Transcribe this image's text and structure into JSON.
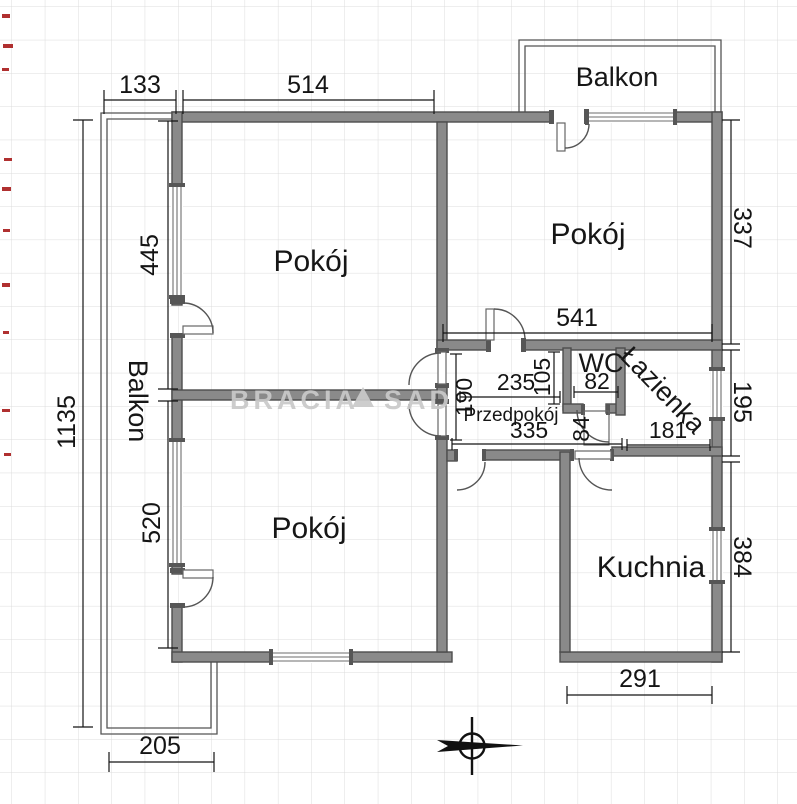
{
  "plan": {
    "watermark": {
      "part1": "BRACIA",
      "part2": "SAD"
    },
    "rooms": {
      "room_top_left": "Pokój",
      "room_top_right": "Pokój",
      "room_bottom_left": "Pokój",
      "kitchen": "Kuchnia",
      "bathroom": "Łazienka",
      "wc": "WC",
      "hallway": "Przedpokój",
      "balcony_left": "Balkon",
      "balcony_top": "Balkon"
    },
    "dims": {
      "d133": "133",
      "d514": "514",
      "d445": "445",
      "d520": "520",
      "d1135": "1135",
      "d205": "205",
      "d541": "541",
      "d337": "337",
      "d195": "195",
      "d384": "384",
      "d291": "291",
      "d235": "235",
      "d190": "190",
      "d105": "105",
      "d335": "335",
      "d82": "82",
      "d84": "84",
      "d181": "181"
    },
    "colors": {
      "wall": "#8a8a8a",
      "wall_outline": "#4d4d4d",
      "dimension_text": "#141414",
      "grid": "#dcdcdc",
      "watermark": "#c9c9c9",
      "artifact_red": "#b03030"
    }
  }
}
